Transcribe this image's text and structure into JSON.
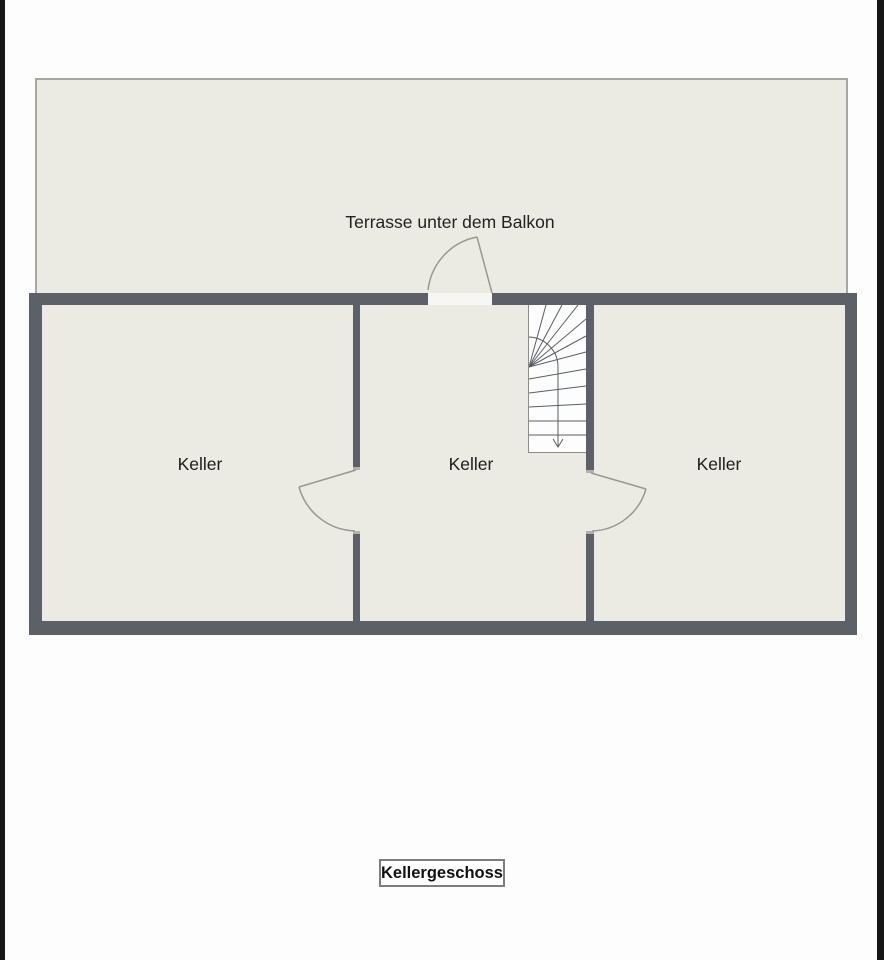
{
  "plan": {
    "terrace_label": "Terrasse unter dem Balkon",
    "rooms": [
      {
        "label": "Keller"
      },
      {
        "label": "Keller"
      },
      {
        "label": "Keller"
      }
    ],
    "floor_caption": "Kellergeschoss",
    "colors": {
      "wall": "#5c6067",
      "floor": "#ebebe3",
      "frame": "#161616",
      "door_line": "#999993",
      "stair_line": "#5a5d62",
      "terrace_border": "#a7a7a2",
      "caption_border": "#7d7d7d",
      "text": "#1c1c1c"
    }
  }
}
